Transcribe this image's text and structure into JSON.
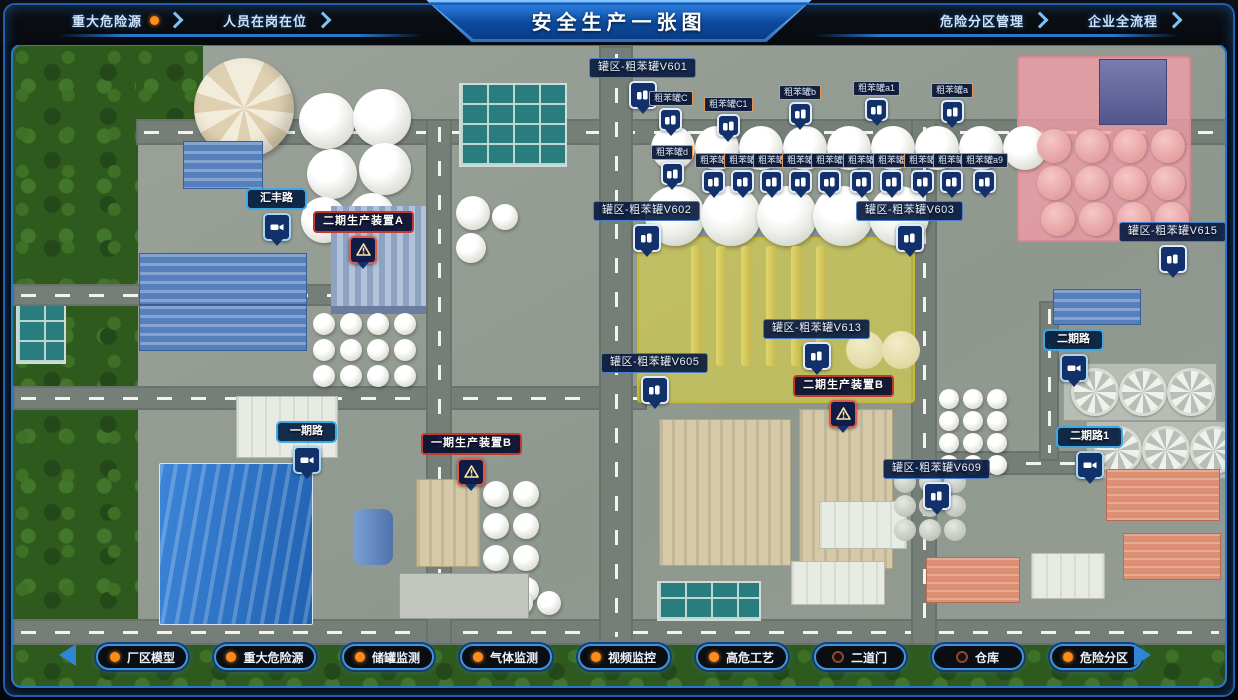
{
  "header": {
    "title": "安全生产一张图",
    "nav_left": [
      {
        "label": "重大危险源",
        "active_dot": true
      },
      {
        "label": "人员在岗在位",
        "active_dot": false
      }
    ],
    "nav_right": [
      {
        "label": "危险分区管理",
        "active_dot": false
      },
      {
        "label": "企业全流程",
        "active_dot": false
      }
    ]
  },
  "toolbar": {
    "buttons": [
      {
        "label": "厂区模型",
        "dot": "on"
      },
      {
        "label": "重大危险源",
        "dot": "on"
      },
      {
        "label": "储罐监测",
        "dot": "on"
      },
      {
        "label": "气体监测",
        "dot": "on"
      },
      {
        "label": "视频监控",
        "dot": "on"
      },
      {
        "label": "高危工艺",
        "dot": "on"
      },
      {
        "label": "二道门",
        "dot": "off"
      },
      {
        "label": "仓库",
        "dot": "off"
      },
      {
        "label": "危险分区",
        "dot": "on"
      }
    ],
    "dot_on_color": "#ff8c1a"
  },
  "map": {
    "zones": [
      {
        "name": "phase2-unit-b-highlight-zone",
        "fill": "rgba(230,219,60,0.55)",
        "border": "#c8bb30",
        "x": 624,
        "y": 191,
        "w": 274,
        "h": 162
      },
      {
        "name": "hazard-tank-highlight-zone",
        "fill": "rgba(243,158,168,0.78)",
        "border": "#da8894",
        "x": 1004,
        "y": 10,
        "w": 170,
        "h": 182
      }
    ],
    "markers": [
      {
        "text": "罐区-粗苯罐V601",
        "kind": "tankzone",
        "x": 576,
        "y": 12,
        "pin": "tank"
      },
      {
        "text": "粗苯罐C",
        "kind": "tanksmall",
        "x": 636,
        "y": 45,
        "pin": "tank"
      },
      {
        "text": "粗苯罐C1",
        "kind": "tanksmall",
        "x": 691,
        "y": 51,
        "pin": "tank"
      },
      {
        "text": "粗苯罐b",
        "kind": "tanksmall",
        "x": 766,
        "y": 39,
        "pin": "tank"
      },
      {
        "text": "粗苯罐a1",
        "kind": "tanksmall",
        "x": 840,
        "y": 35,
        "pin": "tank"
      },
      {
        "text": "粗苯罐a",
        "kind": "tanksmall",
        "x": 918,
        "y": 37,
        "pin": "tank"
      },
      {
        "text": "粗苯罐d",
        "kind": "tanksmall",
        "x": 638,
        "y": 99,
        "pin": "tank"
      },
      {
        "text": "粗苯罐",
        "kind": "tanksmall",
        "x": 682,
        "y": 107,
        "pin": "tank"
      },
      {
        "text": "粗苯罐",
        "kind": "tanksmall",
        "x": 711,
        "y": 107,
        "pin": "tank"
      },
      {
        "text": "粗苯罐",
        "kind": "tanksmall",
        "x": 740,
        "y": 107,
        "pin": "tank"
      },
      {
        "text": "粗苯罐",
        "kind": "tanksmall",
        "x": 769,
        "y": 107,
        "pin": "tank"
      },
      {
        "text": "粗苯罐",
        "kind": "tanksmall",
        "x": 798,
        "y": 107,
        "pin": "tank"
      },
      {
        "text": "粗苯罐",
        "kind": "tanksmall",
        "x": 830,
        "y": 107,
        "pin": "tank"
      },
      {
        "text": "粗苯罐",
        "kind": "tanksmall",
        "x": 860,
        "y": 107,
        "pin": "tank"
      },
      {
        "text": "粗苯罐",
        "kind": "tanksmall",
        "x": 891,
        "y": 107,
        "pin": "tank"
      },
      {
        "text": "粗苯罐",
        "kind": "tanksmall",
        "x": 920,
        "y": 107,
        "pin": "tank"
      },
      {
        "text": "粗苯罐a9",
        "kind": "tanksmall",
        "x": 948,
        "y": 107,
        "pin": "tank"
      },
      {
        "text": "罐区-粗苯罐V602",
        "kind": "tankzone",
        "x": 580,
        "y": 155,
        "pin": "tank"
      },
      {
        "text": "罐区-粗苯罐V603",
        "kind": "tankzone",
        "x": 843,
        "y": 155,
        "pin": "tank"
      },
      {
        "text": "罐区-粗苯罐V613",
        "kind": "tankzone",
        "x": 750,
        "y": 273,
        "pin": "tank"
      },
      {
        "text": "罐区-粗苯罐V605",
        "kind": "tankzone",
        "x": 588,
        "y": 307,
        "pin": "tank"
      },
      {
        "text": "罐区-粗苯罐V609",
        "kind": "tankzone",
        "x": 870,
        "y": 413,
        "pin": "tank"
      },
      {
        "text": "罐区-粗苯罐V615",
        "kind": "tankzone",
        "x": 1106,
        "y": 176,
        "pin": "tank"
      },
      {
        "text": "汇丰路",
        "kind": "road",
        "x": 233,
        "y": 142,
        "pin": "camera"
      },
      {
        "text": "一期路",
        "kind": "road",
        "x": 263,
        "y": 375,
        "pin": "camera"
      },
      {
        "text": "二期路",
        "kind": "road",
        "x": 1030,
        "y": 283,
        "pin": "camera"
      },
      {
        "text": "二期路1",
        "kind": "road",
        "x": 1043,
        "y": 380,
        "pin": "camera"
      },
      {
        "text": "二期生产装置A",
        "kind": "unit",
        "x": 300,
        "y": 165,
        "pin": "warning"
      },
      {
        "text": "一期生产装置B",
        "kind": "unit",
        "x": 408,
        "y": 387,
        "pin": "warning"
      },
      {
        "text": "二期生产装置B",
        "kind": "unit",
        "x": 780,
        "y": 329,
        "pin": "warning"
      }
    ]
  }
}
